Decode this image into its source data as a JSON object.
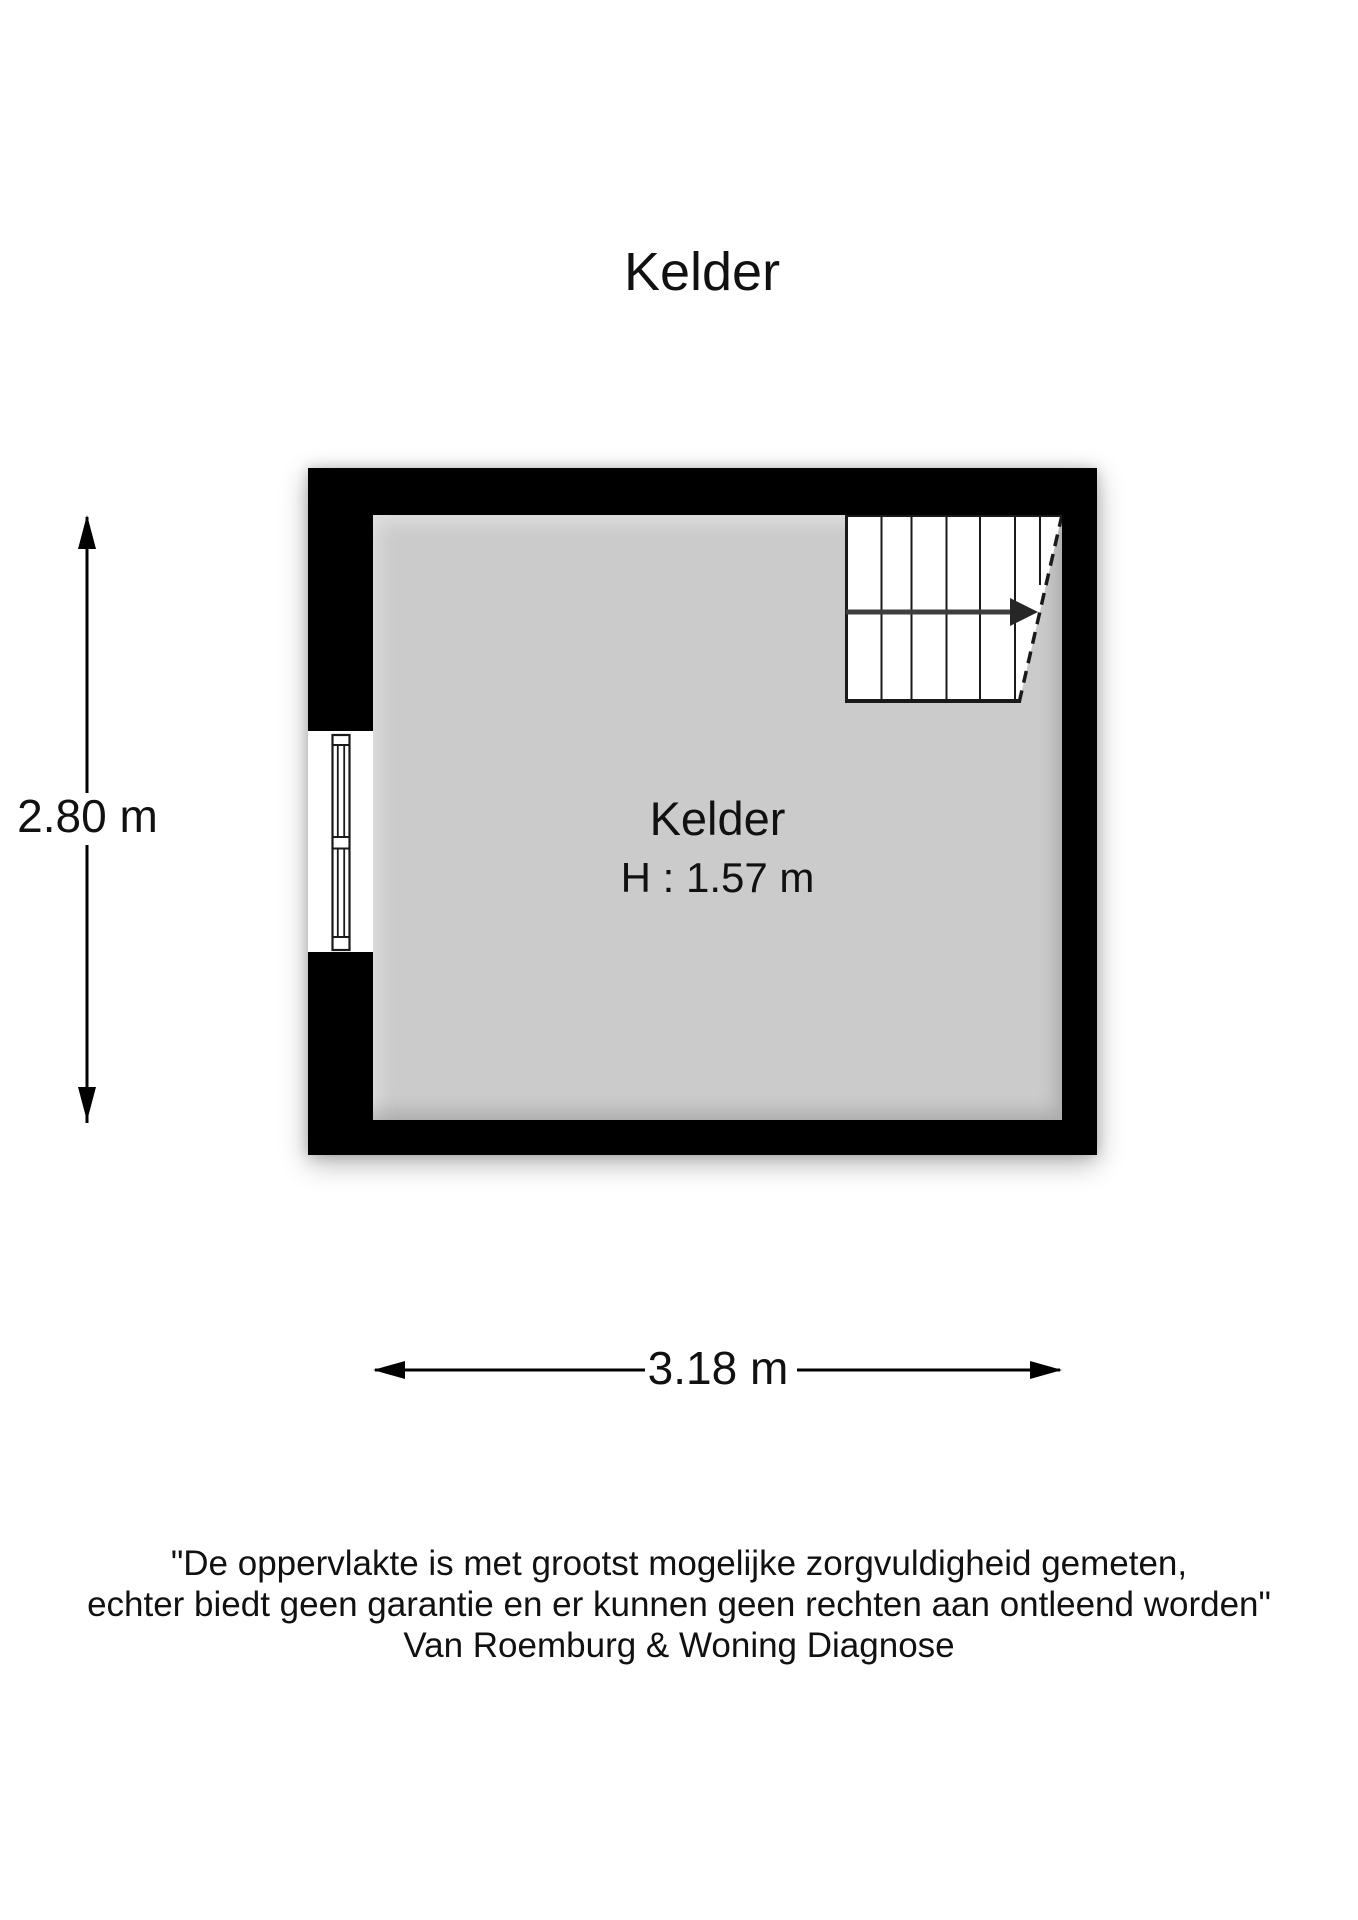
{
  "title": "Kelder",
  "floorplan": {
    "room_label": "Kelder",
    "room_height_label": "H : 1.57 m",
    "features": {
      "stairs": "staircase-top-right-with-direction-arrow",
      "window": "window-left-wall"
    },
    "colors": {
      "wall": "#000000",
      "floor": "#cbcbcb",
      "stairs": "#ffffff",
      "line": "#1a1a1a"
    }
  },
  "dimensions": {
    "vertical_label": "2.80 m",
    "horizontal_label": "3.18 m"
  },
  "disclaimer": {
    "line1": "\"De oppervlakte is met grootst mogelijke zorgvuldigheid gemeten,",
    "line2": "echter biedt geen garantie en er kunnen geen rechten aan ontleend worden\"",
    "line3": "Van Roemburg & Woning Diagnose"
  }
}
